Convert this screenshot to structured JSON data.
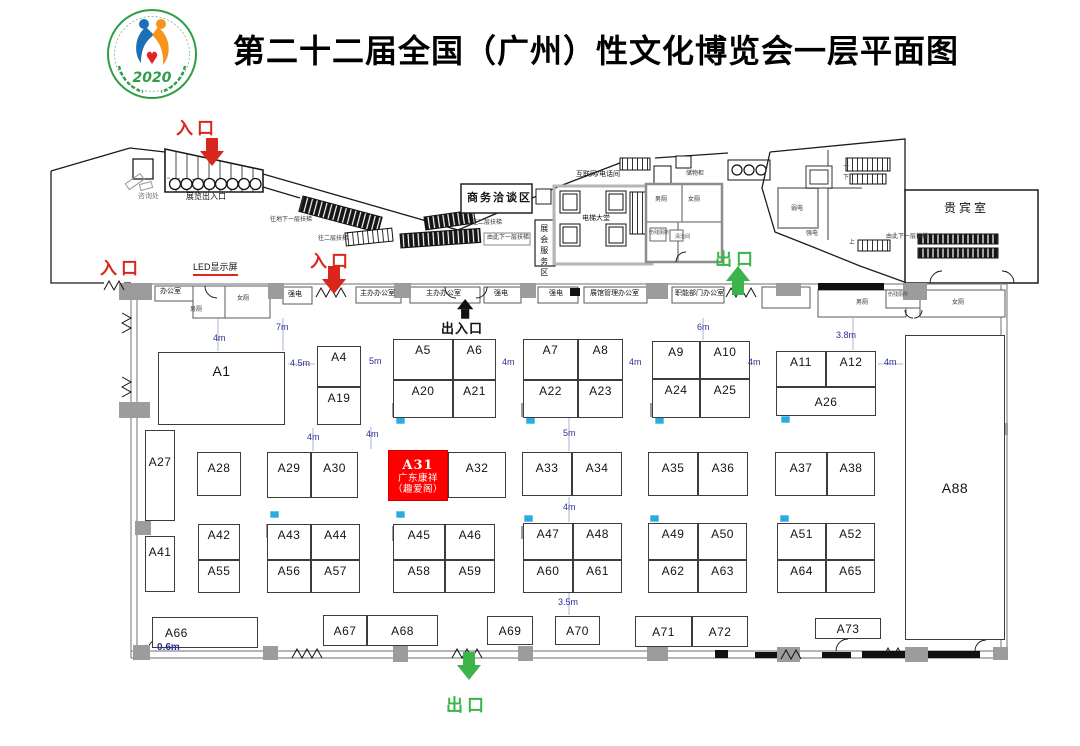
{
  "title": "第二十二届全国（广州）性文化博览会一层平面图",
  "logo": {
    "year": "2020"
  },
  "colors": {
    "entrance_red": "#da251c",
    "exit_green": "#3bb449",
    "dimension_blue": "#2e3192",
    "highlight_booth": "#fe0000"
  },
  "highlight_booth": {
    "id": "A31",
    "company": "广东康祥",
    "brand": "（趣爱阁）"
  },
  "booths": [
    {
      "id": "A1",
      "x": 158,
      "y": 352,
      "w": 127,
      "h": 73,
      "cls": "big",
      "pt": 10
    },
    {
      "id": "A4",
      "x": 317,
      "y": 346,
      "w": 44,
      "h": 41
    },
    {
      "id": "A19",
      "x": 317,
      "y": 387,
      "w": 44,
      "h": 38
    },
    {
      "id": "A5",
      "x": 393,
      "y": 339,
      "w": 60,
      "h": 41
    },
    {
      "id": "A6",
      "x": 453,
      "y": 339,
      "w": 43,
      "h": 41
    },
    {
      "id": "A20",
      "x": 393,
      "y": 380,
      "w": 60,
      "h": 38
    },
    {
      "id": "A21",
      "x": 453,
      "y": 380,
      "w": 43,
      "h": 38
    },
    {
      "id": "A7",
      "x": 523,
      "y": 339,
      "w": 55,
      "h": 41
    },
    {
      "id": "A8",
      "x": 578,
      "y": 339,
      "w": 45,
      "h": 41
    },
    {
      "id": "A22",
      "x": 523,
      "y": 380,
      "w": 55,
      "h": 38
    },
    {
      "id": "A23",
      "x": 578,
      "y": 380,
      "w": 45,
      "h": 38
    },
    {
      "id": "A9",
      "x": 652,
      "y": 341,
      "w": 48,
      "h": 38
    },
    {
      "id": "A10",
      "x": 700,
      "y": 341,
      "w": 50,
      "h": 38
    },
    {
      "id": "A24",
      "x": 652,
      "y": 379,
      "w": 48,
      "h": 39
    },
    {
      "id": "A25",
      "x": 700,
      "y": 379,
      "w": 50,
      "h": 39
    },
    {
      "id": "A11",
      "x": 776,
      "y": 351,
      "w": 50,
      "h": 36
    },
    {
      "id": "A12",
      "x": 826,
      "y": 351,
      "w": 50,
      "h": 36
    },
    {
      "id": "A26",
      "x": 776,
      "y": 387,
      "w": 100,
      "h": 29,
      "va": "c"
    },
    {
      "id": "A88",
      "x": 905,
      "y": 335,
      "w": 100,
      "h": 305,
      "cls": "big",
      "va": "c"
    },
    {
      "id": "A27",
      "x": 145,
      "y": 430,
      "w": 30,
      "h": 91,
      "pt": 24
    },
    {
      "id": "A28",
      "x": 197,
      "y": 452,
      "w": 44,
      "h": 44,
      "pt": 8
    },
    {
      "id": "A29",
      "x": 267,
      "y": 452,
      "w": 44,
      "h": 46,
      "pt": 8
    },
    {
      "id": "A30",
      "x": 311,
      "y": 452,
      "w": 47,
      "h": 46,
      "pt": 8
    },
    {
      "id": "A31",
      "x": 388,
      "y": 450,
      "w": 60,
      "h": 51,
      "cls": "red",
      "lines": [
        "A31",
        "广东康祥",
        "（趣爱阁）"
      ]
    },
    {
      "id": "A32",
      "x": 448,
      "y": 452,
      "w": 58,
      "h": 46,
      "pt": 8
    },
    {
      "id": "A33",
      "x": 522,
      "y": 452,
      "w": 50,
      "h": 44,
      "pt": 8
    },
    {
      "id": "A34",
      "x": 572,
      "y": 452,
      "w": 50,
      "h": 44,
      "pt": 8
    },
    {
      "id": "A35",
      "x": 648,
      "y": 452,
      "w": 50,
      "h": 44,
      "pt": 8
    },
    {
      "id": "A36",
      "x": 698,
      "y": 452,
      "w": 50,
      "h": 44,
      "pt": 8
    },
    {
      "id": "A37",
      "x": 775,
      "y": 452,
      "w": 52,
      "h": 44,
      "pt": 8
    },
    {
      "id": "A38",
      "x": 827,
      "y": 452,
      "w": 48,
      "h": 44,
      "pt": 8
    },
    {
      "id": "A41",
      "x": 145,
      "y": 536,
      "w": 30,
      "h": 56,
      "pt": 8
    },
    {
      "id": "A42",
      "x": 198,
      "y": 524,
      "w": 42,
      "h": 36
    },
    {
      "id": "A55",
      "x": 198,
      "y": 560,
      "w": 42,
      "h": 33
    },
    {
      "id": "A43",
      "x": 267,
      "y": 524,
      "w": 44,
      "h": 36
    },
    {
      "id": "A44",
      "x": 311,
      "y": 524,
      "w": 49,
      "h": 36
    },
    {
      "id": "A56",
      "x": 267,
      "y": 560,
      "w": 44,
      "h": 33
    },
    {
      "id": "A57",
      "x": 311,
      "y": 560,
      "w": 49,
      "h": 33
    },
    {
      "id": "A45",
      "x": 393,
      "y": 524,
      "w": 52,
      "h": 36
    },
    {
      "id": "A46",
      "x": 445,
      "y": 524,
      "w": 50,
      "h": 36
    },
    {
      "id": "A58",
      "x": 393,
      "y": 560,
      "w": 52,
      "h": 33
    },
    {
      "id": "A59",
      "x": 445,
      "y": 560,
      "w": 50,
      "h": 33
    },
    {
      "id": "A47",
      "x": 523,
      "y": 523,
      "w": 50,
      "h": 37
    },
    {
      "id": "A48",
      "x": 573,
      "y": 523,
      "w": 49,
      "h": 37
    },
    {
      "id": "A60",
      "x": 523,
      "y": 560,
      "w": 50,
      "h": 33
    },
    {
      "id": "A61",
      "x": 573,
      "y": 560,
      "w": 49,
      "h": 33
    },
    {
      "id": "A49",
      "x": 648,
      "y": 523,
      "w": 50,
      "h": 37
    },
    {
      "id": "A50",
      "x": 698,
      "y": 523,
      "w": 49,
      "h": 37
    },
    {
      "id": "A62",
      "x": 648,
      "y": 560,
      "w": 50,
      "h": 33
    },
    {
      "id": "A63",
      "x": 698,
      "y": 560,
      "w": 49,
      "h": 33
    },
    {
      "id": "A51",
      "x": 777,
      "y": 523,
      "w": 49,
      "h": 37
    },
    {
      "id": "A52",
      "x": 826,
      "y": 523,
      "w": 49,
      "h": 37
    },
    {
      "id": "A64",
      "x": 777,
      "y": 560,
      "w": 49,
      "h": 33
    },
    {
      "id": "A65",
      "x": 826,
      "y": 560,
      "w": 49,
      "h": 33
    },
    {
      "id": "A66",
      "x": 152,
      "y": 617,
      "w": 106,
      "h": 31,
      "va": "c",
      "ha": "l"
    },
    {
      "id": "A67",
      "x": 323,
      "y": 615,
      "w": 44,
      "h": 31,
      "va": "c"
    },
    {
      "id": "A68",
      "x": 367,
      "y": 615,
      "w": 71,
      "h": 31,
      "va": "c"
    },
    {
      "id": "A69",
      "x": 487,
      "y": 616,
      "w": 46,
      "h": 29,
      "va": "c"
    },
    {
      "id": "A70",
      "x": 555,
      "y": 616,
      "w": 45,
      "h": 29,
      "va": "c"
    },
    {
      "id": "A71",
      "x": 635,
      "y": 616,
      "w": 57,
      "h": 31,
      "va": "c"
    },
    {
      "id": "A72",
      "x": 692,
      "y": 616,
      "w": 56,
      "h": 31,
      "va": "c"
    },
    {
      "id": "A73",
      "x": 815,
      "y": 618,
      "w": 66,
      "h": 21,
      "va": "c"
    }
  ],
  "labels": [
    {
      "t": "咨询处",
      "x": 138,
      "y": 193,
      "cls": "s6 gray",
      "name": "info-desk-label"
    },
    {
      "t": "展览出入口",
      "x": 186,
      "y": 193,
      "cls": "s7",
      "name": "exhibition-gate-label"
    },
    {
      "t": "LED显示屏",
      "x": 193,
      "y": 263,
      "cls": "s8 led",
      "name": "led-screen-label"
    },
    {
      "t": "往地下一层扶梯",
      "x": 270,
      "y": 217,
      "cls": "s5",
      "name": "escalator-basement-label"
    },
    {
      "t": "往二层扶梯",
      "x": 318,
      "y": 236,
      "cls": "s5",
      "name": "escalator-2f-label"
    },
    {
      "t": "往二层扶梯",
      "x": 472,
      "y": 220,
      "cls": "s5",
      "name": "escalator-2f-label-2"
    },
    {
      "t": "由此下一层扶梯",
      "x": 487,
      "y": 235,
      "cls": "s5",
      "name": "escalator-down-label"
    },
    {
      "t": "商务洽谈区",
      "x": 467,
      "y": 192,
      "cls": "s10",
      "name": "business-zone-label"
    },
    {
      "t": "展会服务区",
      "x": 539,
      "y": 224,
      "cls": "s7 vert",
      "name": "service-zone-label"
    },
    {
      "t": "互联网/电话间",
      "x": 576,
      "y": 171,
      "cls": "s6",
      "name": "internet-phone-label"
    },
    {
      "t": "储物柜",
      "x": 686,
      "y": 171,
      "cls": "s5",
      "name": "locker-label"
    },
    {
      "t": "电梯大堂",
      "x": 582,
      "y": 215,
      "cls": "s6",
      "name": "elevator-lobby-label"
    },
    {
      "t": "男厕",
      "x": 655,
      "y": 197,
      "cls": "s5",
      "name": "mens-toilet-label-1"
    },
    {
      "t": "女厕",
      "x": 688,
      "y": 197,
      "cls": "s5",
      "name": "womens-toilet-label-1"
    },
    {
      "t": "伤残厕所",
      "x": 649,
      "y": 231,
      "cls": "s4",
      "name": "accessible-toilet-label-1"
    },
    {
      "t": "清洁间",
      "x": 675,
      "y": 235,
      "cls": "s4",
      "name": "cleaning-room-label"
    },
    {
      "t": "弱电",
      "x": 791,
      "y": 206,
      "cls": "s5",
      "name": "low-voltage-label"
    },
    {
      "t": "强电",
      "x": 806,
      "y": 231,
      "cls": "s5",
      "name": "high-voltage-label-1"
    },
    {
      "t": "上",
      "x": 843,
      "y": 162,
      "cls": "s5",
      "name": "stairs-up-label-1"
    },
    {
      "t": "下",
      "x": 843,
      "y": 175,
      "cls": "s5",
      "name": "stairs-down-label"
    },
    {
      "t": "上",
      "x": 849,
      "y": 240,
      "cls": "s5",
      "name": "stairs-up-label-2"
    },
    {
      "t": "由此下一层扶梯",
      "x": 886,
      "y": 234,
      "cls": "s5",
      "name": "escalator-down-label-2"
    },
    {
      "t": "贵宾室",
      "x": 944,
      "y": 202,
      "cls": "s11",
      "name": "vip-room-label"
    },
    {
      "t": "办公室",
      "x": 160,
      "y": 288,
      "cls": "s6",
      "name": "office-label"
    },
    {
      "t": "男厕",
      "x": 190,
      "y": 307,
      "cls": "s5",
      "name": "mens-toilet-label-2"
    },
    {
      "t": "女厕",
      "x": 237,
      "y": 296,
      "cls": "s5",
      "name": "womens-toilet-label-2"
    },
    {
      "t": "强电",
      "x": 288,
      "y": 291,
      "cls": "s6",
      "name": "high-voltage-label-2"
    },
    {
      "t": "主办办公室",
      "x": 360,
      "y": 290,
      "cls": "s6",
      "name": "organizer-office-label-1"
    },
    {
      "t": "主办办公室",
      "x": 426,
      "y": 290,
      "cls": "s6",
      "name": "organizer-office-label-2"
    },
    {
      "t": "强电",
      "x": 494,
      "y": 290,
      "cls": "s6",
      "name": "high-voltage-label-3"
    },
    {
      "t": "强电",
      "x": 549,
      "y": 290,
      "cls": "s6",
      "name": "high-voltage-label-4"
    },
    {
      "t": "展馆管理办公室",
      "x": 590,
      "y": 290,
      "cls": "s6",
      "name": "hall-management-office-label"
    },
    {
      "t": "职能部门办公室",
      "x": 675,
      "y": 290,
      "cls": "s6",
      "name": "functional-dept-office-label"
    },
    {
      "t": "男厕",
      "x": 856,
      "y": 300,
      "cls": "s5",
      "name": "mens-toilet-label-3"
    },
    {
      "t": "伤残厕所",
      "x": 888,
      "y": 293,
      "cls": "s4",
      "name": "accessible-toilet-label-2"
    },
    {
      "t": "女厕",
      "x": 952,
      "y": 300,
      "cls": "s5",
      "name": "womens-toilet-label-3"
    }
  ],
  "dims": [
    {
      "t": "4m",
      "x": 213,
      "y": 333
    },
    {
      "t": "7m",
      "x": 276,
      "y": 322
    },
    {
      "t": "4.5m",
      "x": 290,
      "y": 358
    },
    {
      "t": "5m",
      "x": 369,
      "y": 356
    },
    {
      "t": "4m",
      "x": 502,
      "y": 357
    },
    {
      "t": "4m",
      "x": 629,
      "y": 357
    },
    {
      "t": "4m",
      "x": 748,
      "y": 357
    },
    {
      "t": "4m",
      "x": 884,
      "y": 357
    },
    {
      "t": "3.8m",
      "x": 836,
      "y": 330
    },
    {
      "t": "6m",
      "x": 697,
      "y": 322
    },
    {
      "t": "4m",
      "x": 307,
      "y": 432
    },
    {
      "t": "4m",
      "x": 366,
      "y": 429
    },
    {
      "t": "5m",
      "x": 563,
      "y": 428
    },
    {
      "t": "4m",
      "x": 563,
      "y": 502
    },
    {
      "t": "3.5m",
      "x": 558,
      "y": 597
    },
    {
      "t": "0.6m",
      "x": 157,
      "y": 642,
      "b": true
    }
  ],
  "markers": [
    {
      "name": "entrance-top",
      "t": "入口",
      "x": 176,
      "y": 114,
      "cls": "red",
      "arrow": {
        "dir": "down",
        "x": 200,
        "y": 138,
        "c": "red"
      }
    },
    {
      "name": "entrance-left",
      "t": "入口",
      "x": 100,
      "y": 254,
      "cls": "red"
    },
    {
      "name": "entrance-mid",
      "t": "入口",
      "x": 310,
      "y": 247,
      "cls": "red",
      "arrow": {
        "dir": "down",
        "x": 322,
        "y": 266,
        "c": "red"
      }
    },
    {
      "name": "exit-top",
      "t": "出口",
      "x": 715,
      "y": 245,
      "cls": "green",
      "arrow": {
        "dir": "up",
        "x": 726,
        "y": 266,
        "c": "green"
      }
    },
    {
      "name": "exit-bottom",
      "t": "出口",
      "x": 446,
      "y": 691,
      "cls": "green",
      "arrow": {
        "dir": "down",
        "x": 457,
        "y": 652,
        "c": "green"
      }
    },
    {
      "name": "entrance-exit-gate",
      "t": "出入口",
      "x": 441,
      "y": 318,
      "cls": "black",
      "arrow": {
        "dir": "up",
        "x": 457,
        "y": 299,
        "c": "black",
        "sm": true
      }
    }
  ]
}
